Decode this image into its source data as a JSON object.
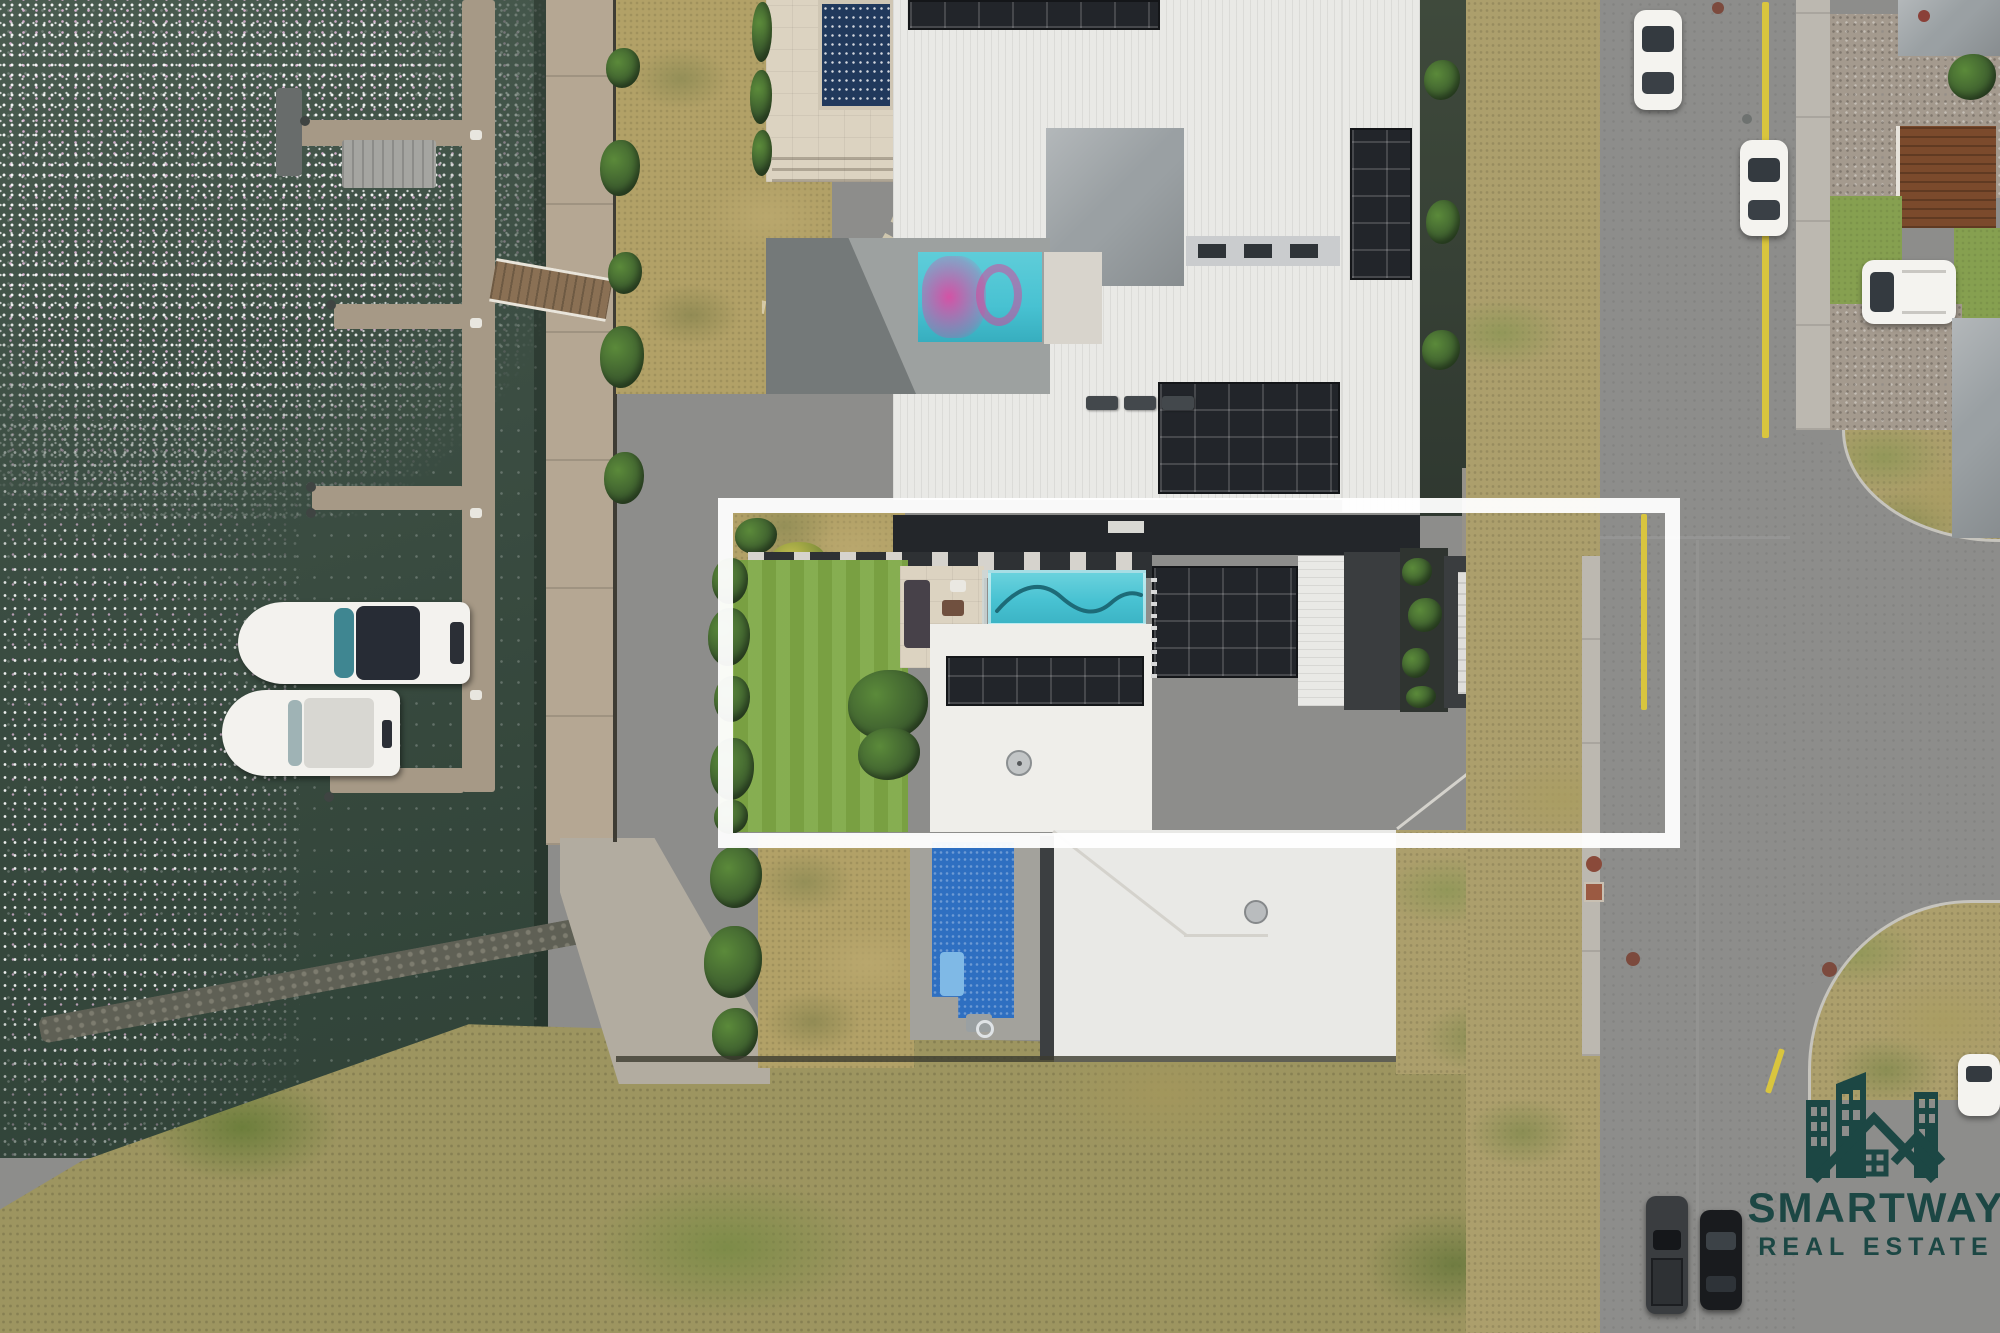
{
  "watermark": {
    "brand_line1": "SMARTWAY",
    "brand_line2": "REAL ESTATE"
  },
  "highlight": {
    "shape": "rectangle-outline",
    "color": "#ffffff",
    "marks": "featured waterfront property"
  },
  "colors": {
    "water": "#36483d",
    "sparkle": "#ffffff",
    "sparklePink": "#ecc0e4",
    "lawnDry": "#b2a167",
    "lawnGreen": "#7fa946",
    "bushDark": "#37552c",
    "bushLight": "#5b8a3a",
    "terrace": "#dcd3c1",
    "poolNavy": "#21395c",
    "poolTeal": "#48c2d2",
    "poolMagenta": "#d84f9e",
    "poolBlue": "#2e6fc1",
    "roofWhite": "#e9e9e6",
    "roofGray": "#9aa0a3",
    "roofCharcoal": "#3a3d3f",
    "solar": "#22252a",
    "courtyard": "#9da1a0",
    "road": "#8d8d8b",
    "yellowLine": "#d9c53e",
    "scrubTan": "#9d9560",
    "boatWhite": "#f3f2ee",
    "carBlack": "#191b1e",
    "deckBrown": "#7b4a2c",
    "logoTeal": "#1c4744"
  }
}
